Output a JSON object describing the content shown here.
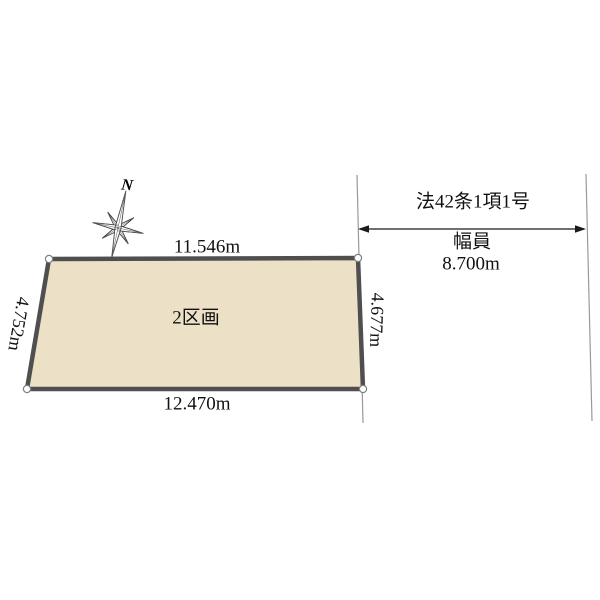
{
  "compass": {
    "north_label": "N"
  },
  "plot": {
    "label": "2区画",
    "fill_color": "#ece0c6",
    "dimensions": {
      "top": "11.546m",
      "bottom": "12.470m",
      "left": "4.752m",
      "right": "4.677m"
    }
  },
  "road": {
    "law_label": "法42条1項1号",
    "width_label": "幅員",
    "width_value": "8.700m"
  }
}
